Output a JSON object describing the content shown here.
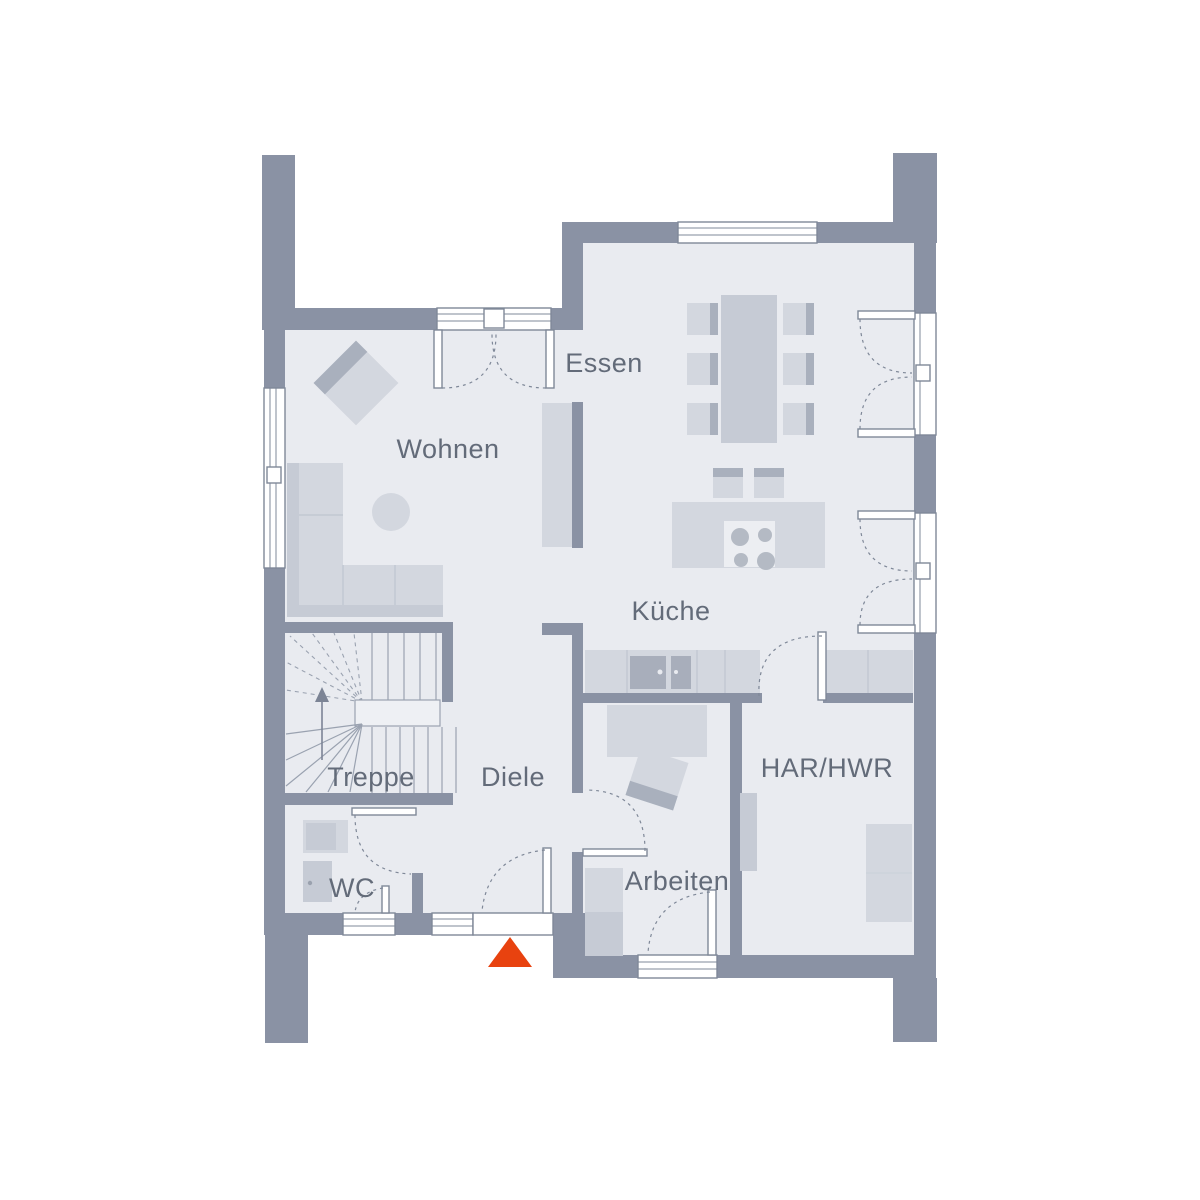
{
  "floorplan": {
    "rooms": [
      {
        "id": "wohnen",
        "label": "Wohnen"
      },
      {
        "id": "essen",
        "label": "Essen"
      },
      {
        "id": "kueche",
        "label": "Küche"
      },
      {
        "id": "treppe",
        "label": "Treppe"
      },
      {
        "id": "diele",
        "label": "Diele"
      },
      {
        "id": "wc",
        "label": "WC"
      },
      {
        "id": "arbeiten",
        "label": "Arbeiten"
      },
      {
        "id": "har_hwr",
        "label": "HAR/HWR"
      }
    ],
    "markers": {
      "entrance_icon": "triangle-up",
      "stairs_direction_icon": "arrow-up"
    },
    "colors": {
      "wall": "#8A92A4",
      "floor": "#E9EBF0",
      "furn": "#D3D7DF",
      "furn_mid": "#C6CBD5",
      "furn_dark": "#A9B0BD",
      "accent": "#E8420F",
      "text": "#636B79"
    }
  }
}
